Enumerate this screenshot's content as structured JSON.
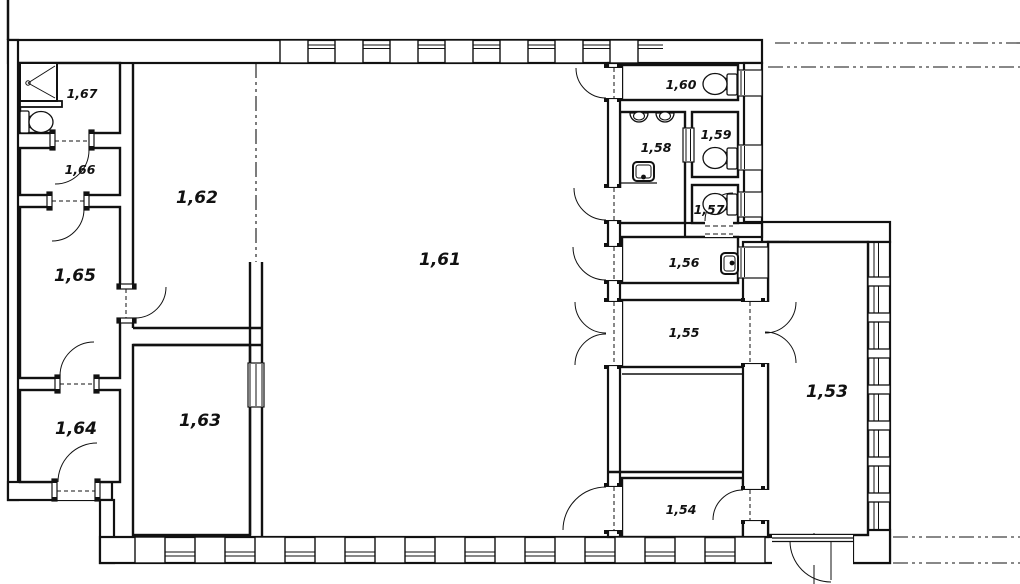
{
  "drawing": {
    "kind": "architectural floor plan",
    "background": "#ffffff",
    "line_color": "#111111"
  },
  "rooms": [
    {
      "number": "1,67",
      "x": 82,
      "y": 98,
      "size": "small"
    },
    {
      "number": "1,66",
      "x": 80,
      "y": 174,
      "size": "small"
    },
    {
      "number": "1,65",
      "x": 75,
      "y": 281,
      "size": "big"
    },
    {
      "number": "1,64",
      "x": 76,
      "y": 434,
      "size": "big"
    },
    {
      "number": "1,62",
      "x": 197,
      "y": 203,
      "size": "big"
    },
    {
      "number": "1,63",
      "x": 200,
      "y": 426,
      "size": "big"
    },
    {
      "number": "1,61",
      "x": 440,
      "y": 265,
      "size": "big"
    },
    {
      "number": "1,60",
      "x": 681,
      "y": 89,
      "size": "small"
    },
    {
      "number": "1,58",
      "x": 656,
      "y": 152,
      "size": "small"
    },
    {
      "number": "1,59",
      "x": 716,
      "y": 139,
      "size": "small"
    },
    {
      "number": "1,57",
      "x": 709,
      "y": 214,
      "size": "small"
    },
    {
      "number": "1,56",
      "x": 684,
      "y": 267,
      "size": "small"
    },
    {
      "number": "1,55",
      "x": 684,
      "y": 337,
      "size": "small"
    },
    {
      "number": "1,54",
      "x": 681,
      "y": 514,
      "size": "small"
    },
    {
      "number": "1,53",
      "x": 827,
      "y": 397,
      "size": "big"
    }
  ],
  "fixtures": [
    {
      "type": "shower",
      "room": "1,67",
      "x": 20,
      "y": 63,
      "w": 37,
      "h": 38,
      "drain": [
        28,
        83
      ]
    },
    {
      "type": "toilet",
      "room": "1,67",
      "tank": [
        20,
        111,
        9,
        22
      ],
      "bowl": [
        41,
        122,
        12,
        10.5
      ],
      "joint": [
        29,
        116
      ]
    },
    {
      "type": "toilet",
      "room": "1,60",
      "tank": [
        727,
        74,
        10,
        21
      ],
      "bowl": [
        715,
        84,
        12,
        10.5
      ],
      "joint": [
        722,
        78
      ]
    },
    {
      "type": "toilet",
      "room": "1,59",
      "tank": [
        727,
        148,
        10,
        21
      ],
      "bowl": [
        715,
        158,
        12,
        10.5
      ],
      "joint": [
        722,
        152
      ]
    },
    {
      "type": "toilet",
      "room": "1,57",
      "tank": [
        727,
        194,
        10,
        21
      ],
      "bowl": [
        715,
        204,
        12,
        10.5
      ],
      "joint": [
        722,
        198
      ]
    },
    {
      "type": "urinal",
      "room": "1,58",
      "cx": 639,
      "cy": 113
    },
    {
      "type": "urinal",
      "room": "1,58",
      "cx": 665,
      "cy": 113
    },
    {
      "type": "sink",
      "room": "1,58",
      "x": 633,
      "y": 162,
      "w": 21,
      "h": 19,
      "tap": [
        643.5,
        177
      ]
    },
    {
      "type": "sink",
      "room": "1,56",
      "x": 721,
      "y": 253,
      "w": 17,
      "h": 21,
      "tap": [
        732,
        263
      ]
    }
  ]
}
